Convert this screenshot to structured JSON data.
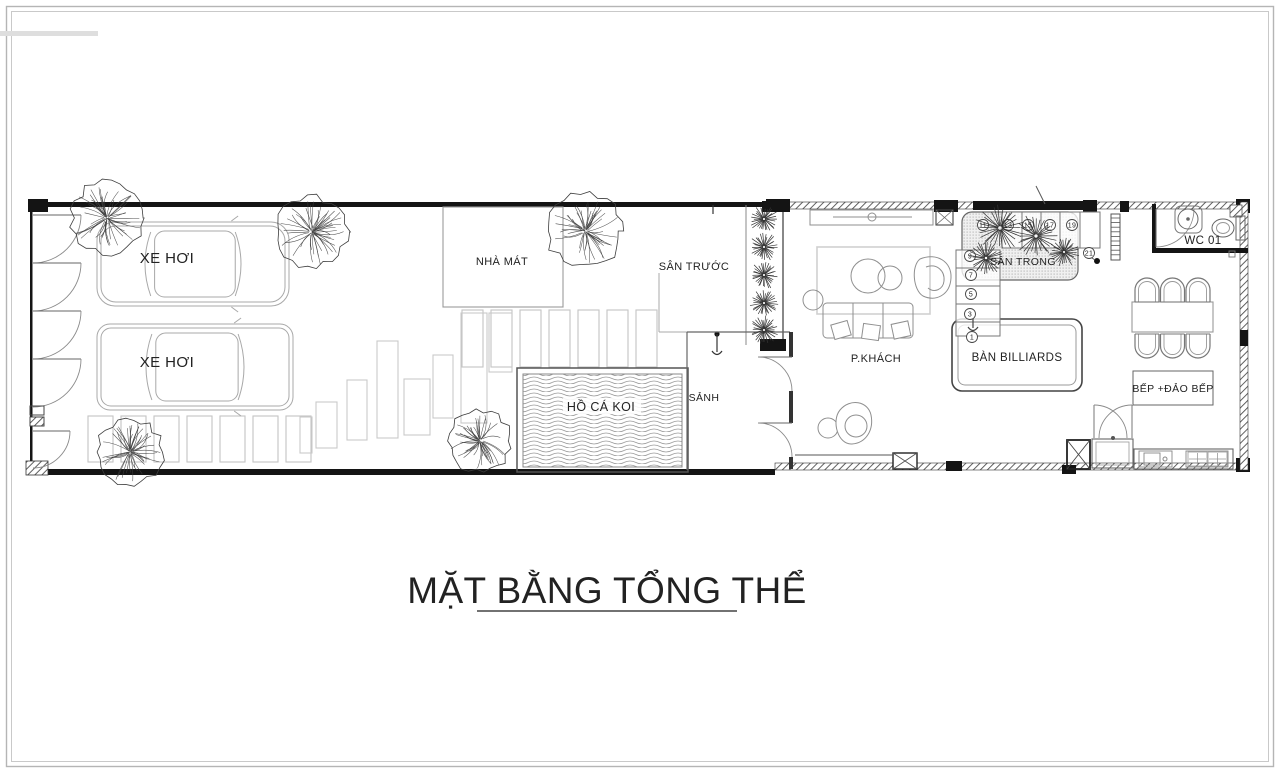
{
  "title": {
    "text": "MẶT BẰNG TỔNG THỂ"
  },
  "labels": {
    "car_top": "XE HƠI",
    "car_bottom": "XE HƠI",
    "pavilion": "NHÀ MÁT",
    "front_yard": "SÂN TRƯỚC",
    "koi_pond": "HỒ CÁ KOI",
    "lobby": "SẢNH",
    "living_room": "P.KHÁCH",
    "billiards_table": "BÀN BILLIARDS",
    "inner_courtyard": "SÂN TRONG",
    "wc": "WC 01",
    "kitchen": "BẾP +ĐẢO BẾP"
  },
  "stairs": {
    "steps": [
      "1",
      "3",
      "5",
      "7",
      "9",
      "11",
      "13",
      "15",
      "17",
      "19",
      "21"
    ]
  },
  "colors": {
    "ink": "#222222",
    "wall": "#141414",
    "furniture": "#8f8f8f",
    "light_furniture": "#a8a8a8",
    "paver": "#c4c4c4",
    "frame": "#b5b5b5",
    "hatch": "#4f4f4f",
    "wave": "#9b9b9b",
    "tree": "#3d3d3d"
  }
}
